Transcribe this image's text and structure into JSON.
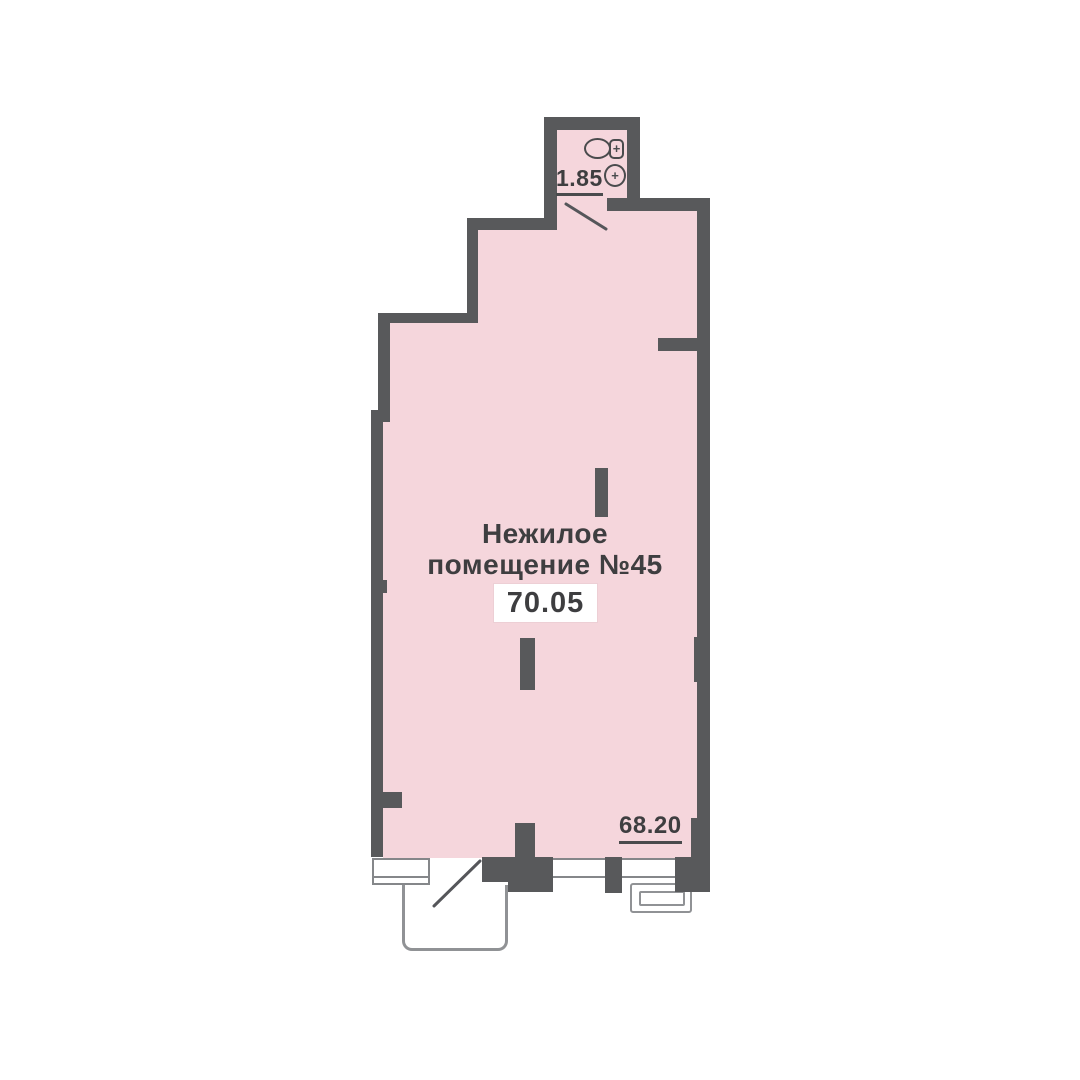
{
  "unit": {
    "name_line1": "Нежилое",
    "name_line2": "помещение №45",
    "total_area": "70.05",
    "room_area": "68.20",
    "bathroom_area": "1.85"
  },
  "icons": {
    "sink": "sink-icon",
    "toilet": "toilet-icon",
    "plus_glyph": "+"
  },
  "colors": {
    "room_fill": "#f5d6dc",
    "wall": "#58595b",
    "outline_gray": "#909295",
    "window_frame": "#85878a",
    "text": "#3e3e40",
    "background": "#ffffff"
  }
}
